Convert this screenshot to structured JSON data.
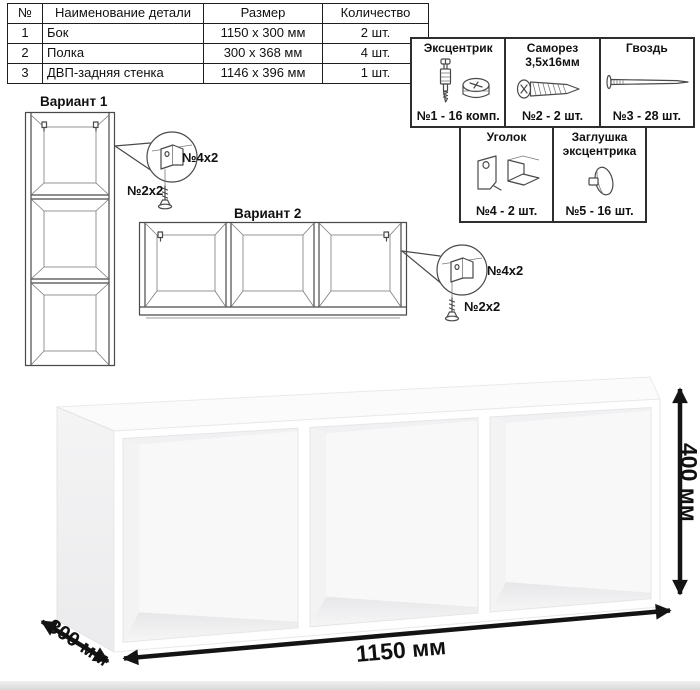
{
  "parts_table": {
    "headers": {
      "num": "№",
      "name": "Наименование детали",
      "size": "Размер",
      "qty": "Количество"
    },
    "rows": [
      {
        "num": "1",
        "name": "Бок",
        "size": "1150 х 300 мм",
        "qty": "2 шт."
      },
      {
        "num": "2",
        "name": "Полка",
        "size": "300 х 368 мм",
        "qty": "4 шт."
      },
      {
        "num": "3",
        "name": "ДВП-задняя стенка",
        "size": "1146 х 396 мм",
        "qty": "1 шт."
      }
    ]
  },
  "hardware": {
    "items": [
      {
        "title": "Эксцентрик",
        "qty_label": "№1 - 16 комп."
      },
      {
        "title": "Саморез 3,5х16мм",
        "qty_label": "№2 - 2 шт."
      },
      {
        "title": "Гвоздь",
        "qty_label": "№3 - 28 шт."
      },
      {
        "title": "Уголок",
        "qty_label": "№4 - 2 шт."
      },
      {
        "title": "Заглушка эксцентрика",
        "qty_label": "№5 - 16 шт."
      }
    ]
  },
  "variant1": {
    "title": "Вариант 1",
    "bracket_label": "№4х2",
    "screw_label": "№2х2"
  },
  "variant2": {
    "title": "Вариант 2",
    "bracket_label": "№4х2",
    "screw_label": "№2х2"
  },
  "dimensions": {
    "width": "1150 мм",
    "height": "400 мм",
    "depth": "300 мм"
  },
  "colors": {
    "line_art": "#4a4a4a",
    "dimension_arrows": "#141414",
    "table_border": "#1f1f1f",
    "hardware_border": "#2e2e2e"
  }
}
